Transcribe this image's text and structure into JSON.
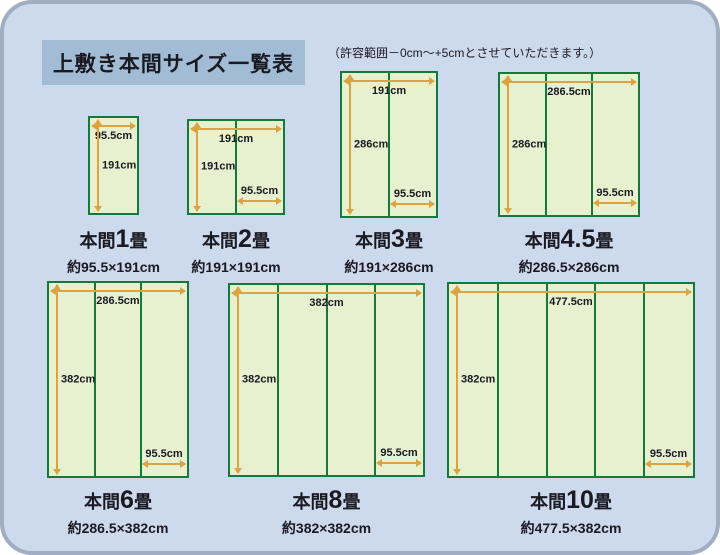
{
  "title": "上敷き本間サイズ一覧表",
  "note": "（許容範囲－0cm～+5cmとさせていただきます。）",
  "colors": {
    "background": "#cdd9ec",
    "frame_border": "#a0adc2",
    "title_box": "#a3bcd5",
    "mat_fill": "#e7f0cf",
    "mat_border": "#15793c",
    "arrow": "#dba342",
    "text": "#1a1a22"
  },
  "diagrams": [
    {
      "prefix": "本間",
      "number": "1",
      "suffix": "畳",
      "size": "約95.5×191cm",
      "width_label": "95.5cm",
      "height_label": "191cm",
      "mat_width_label": null,
      "panels": 1
    },
    {
      "prefix": "本間",
      "number": "2",
      "suffix": "畳",
      "size": "約191×191cm",
      "width_label": "191cm",
      "height_label": "191cm",
      "mat_width_label": "95.5cm",
      "panels": 2
    },
    {
      "prefix": "本間",
      "number": "3",
      "suffix": "畳",
      "size": "約191×286cm",
      "width_label": "191cm",
      "height_label": "286cm",
      "mat_width_label": "95.5cm",
      "panels": 2
    },
    {
      "prefix": "本間",
      "number": "4.5",
      "suffix": "畳",
      "size": "約286.5×286cm",
      "width_label": "286.5cm",
      "height_label": "286cm",
      "mat_width_label": "95.5cm",
      "panels": 3
    },
    {
      "prefix": "本間",
      "number": "6",
      "suffix": "畳",
      "size": "約286.5×382cm",
      "width_label": "286.5cm",
      "height_label": "382cm",
      "mat_width_label": "95.5cm",
      "panels": 3
    },
    {
      "prefix": "本間",
      "number": "8",
      "suffix": "畳",
      "size": "約382×382cm",
      "width_label": "382cm",
      "height_label": "382cm",
      "mat_width_label": "95.5cm",
      "panels": 4
    },
    {
      "prefix": "本間",
      "number": "10",
      "suffix": "畳",
      "size": "約477.5×382cm",
      "width_label": "477.5cm",
      "height_label": "382cm",
      "mat_width_label": "95.5cm",
      "panels": 5
    }
  ]
}
